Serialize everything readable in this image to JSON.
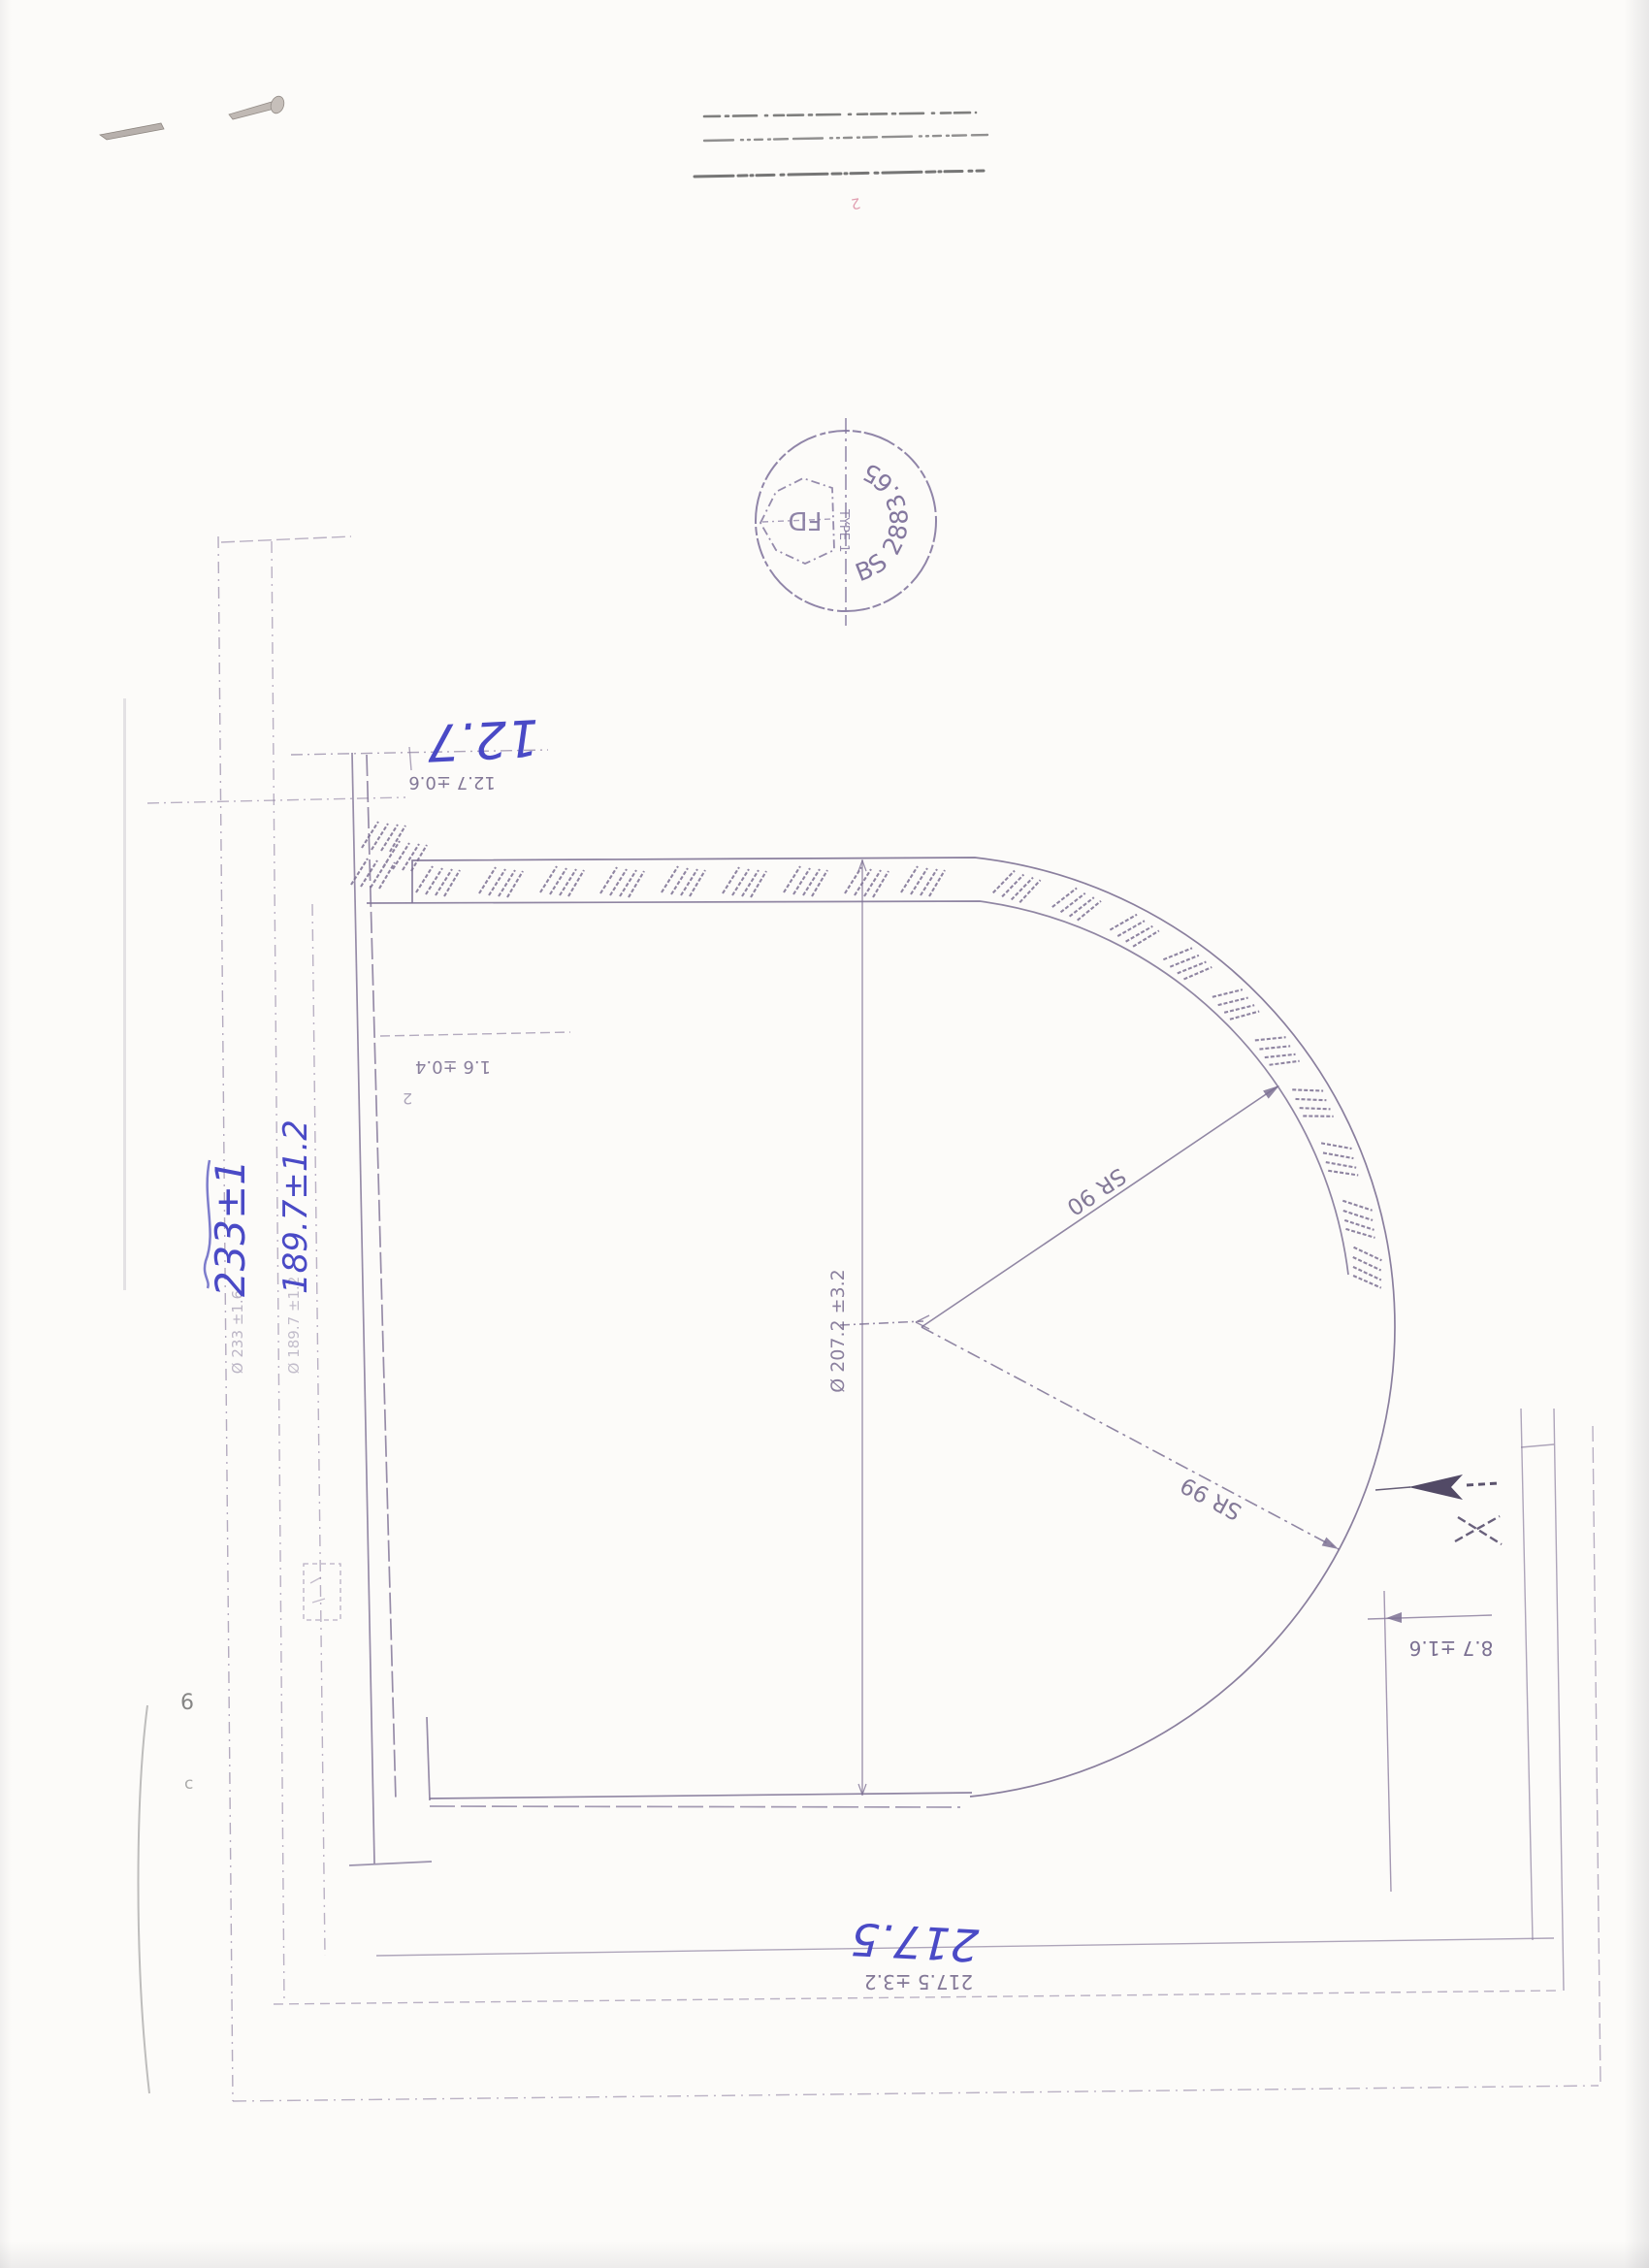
{
  "document": {
    "kind_note": "scanned engineering drawing, sheet rotated 180 degrees"
  },
  "stamp": {
    "code": "BS 2883.65",
    "type_label": "TYPE 1",
    "monogram": "FD"
  },
  "handwritten_blue": {
    "thickness": "12.7",
    "outer_diameter": "233±1",
    "inner_diameter": "189.7±1.2",
    "depth": "217.5"
  },
  "printed_dimensions": {
    "thickness": "12.7 ±0.6",
    "step": "1.6 ±0.4",
    "step_item": "2",
    "knuckle": "8.7 ±1.6",
    "depth": "217.5 ±3.2",
    "bore_diameter": "Ø 207.2 ±3.2",
    "outer_diameter": "Ø 233 ±1.6",
    "inner_diameter": "Ø 189.7 ±1.2",
    "spherical_radius_inner": "SR 90",
    "spherical_radius_outer": "SR 99"
  },
  "stray_marks": {
    "mark_left_upper": "6",
    "mark_left_lower": "c",
    "mark_top_pink": "2"
  },
  "colors": {
    "ink": "#6e6287",
    "line": "#8d80a0",
    "blue_pen": "#4a4ac6",
    "stamp_ink": "#84789f",
    "smudge": "#4a4a4a"
  }
}
